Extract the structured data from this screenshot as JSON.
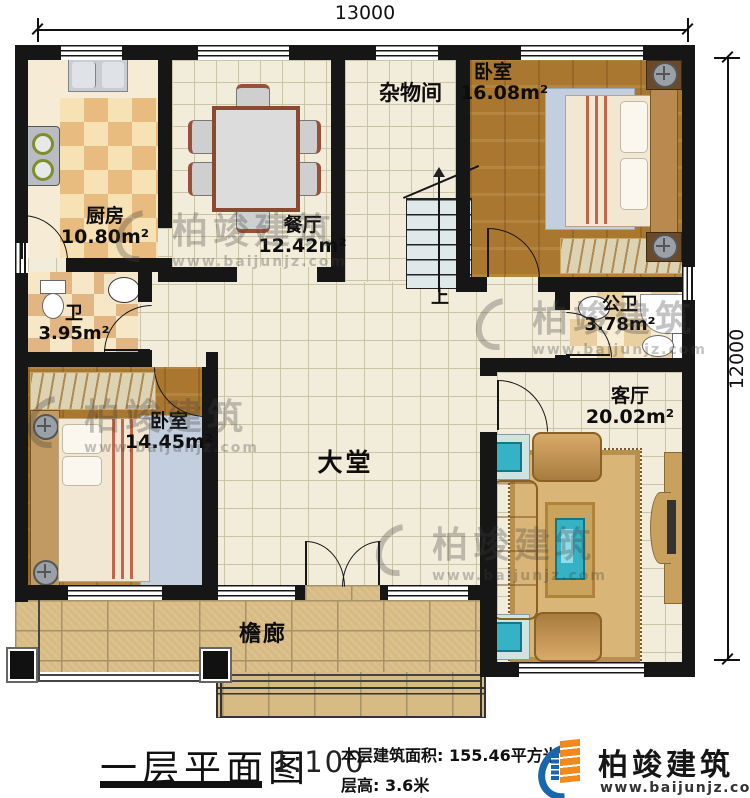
{
  "dimensions": {
    "top": "13000",
    "right": "12000"
  },
  "rooms": [
    {
      "id": "kitchen",
      "name": "厨房",
      "area": "10.80m²"
    },
    {
      "id": "dining",
      "name": "餐厅",
      "area": "12.42m²"
    },
    {
      "id": "storage",
      "name": "杂物间",
      "area": ""
    },
    {
      "id": "bedroom_tr",
      "name": "卧室",
      "area": "16.08m²"
    },
    {
      "id": "bath",
      "name": "卫",
      "area": "3.95m²"
    },
    {
      "id": "public_bath",
      "name": "公卫",
      "area": "3.78m²"
    },
    {
      "id": "bedroom_bl",
      "name": "卧室",
      "area": "14.45m²"
    },
    {
      "id": "hall",
      "name": "大堂",
      "area": ""
    },
    {
      "id": "living",
      "name": "客厅",
      "area": "20.02m²"
    },
    {
      "id": "porch",
      "name": "檐廊",
      "area": ""
    }
  ],
  "stairs": {
    "up_label": "上"
  },
  "title_block": {
    "title": "一层平面图",
    "scale": "1:100",
    "area_line": "本层建筑面积: 155.46平方米",
    "height_line": "层高: 3.6米"
  },
  "brand": {
    "name": "柏竣建筑",
    "website": "www.baijunjz.com"
  },
  "watermark": {
    "text": "柏竣建筑",
    "url": "www.baijunjz.com"
  },
  "colors": {
    "wall": "#161616",
    "brand_blue": "#1a66ad",
    "brand_orange": "#f08a1e",
    "wood_floor": "#a9772f",
    "cream_tile": "#f2eddb",
    "porch_stone": "#d8bb83",
    "sofa_gold": "#c89858",
    "glass_teal": "#35b2c4"
  }
}
